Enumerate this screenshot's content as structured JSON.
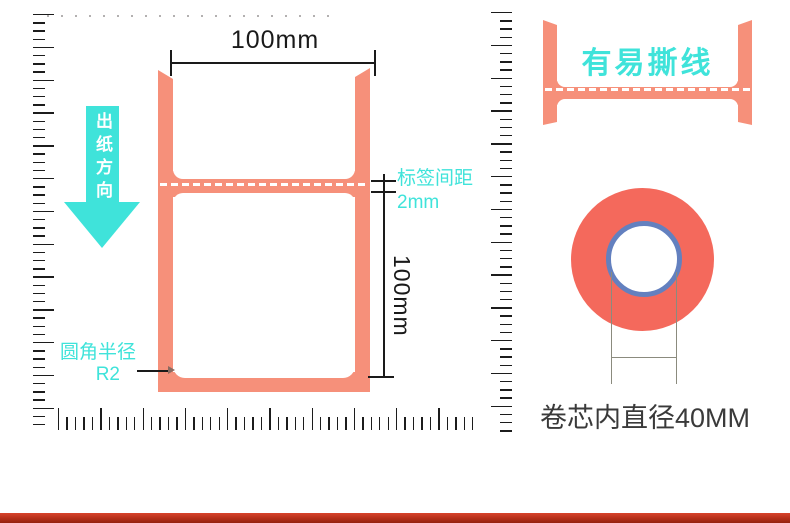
{
  "colors": {
    "coral": "#F6907A",
    "coral_deep": "#F4695C",
    "cyan": "#3FE3DA",
    "blue_ring": "#6380BF",
    "ink": "#1A1A1A",
    "gray_text": "#3A3A3A",
    "ruler_tick": "#1c1c1c"
  },
  "label": {
    "width_dim": "100mm",
    "height_dim": "100mm",
    "direction": "出纸方向",
    "gap_line1": "标签间距",
    "gap_line2": "2mm",
    "corner_line1": "圆角半径",
    "corner_line2": "R2"
  },
  "tear": {
    "caption": "有易撕线"
  },
  "roll": {
    "caption": "卷芯内直径40MM"
  }
}
